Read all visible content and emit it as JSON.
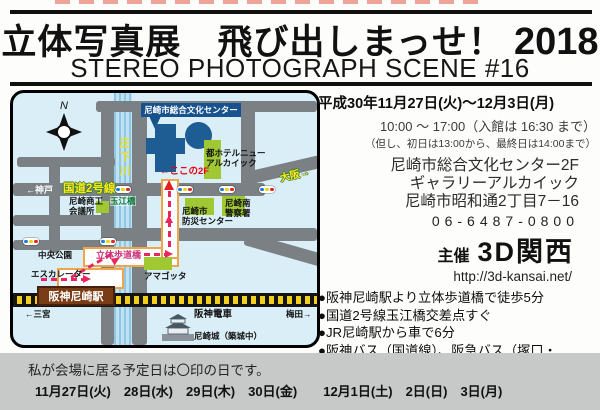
{
  "header": {
    "title_main": "立体写真展　飛び出しまっせ！",
    "title_year": "2018",
    "subtitle": "STEREO PHOTOGRAPH SCENE #16"
  },
  "info": {
    "date_line": "平成30年11月27日(火)～12月3日(月)",
    "hours_line": "10:00 ～ 17:00（入館は 16:30 まで）",
    "hours_note": "（但し、初日は13:00から、最終日は14:00まで）",
    "venue_line1": "尼崎市総合文化センター2F",
    "venue_line2": "ギャラリーアルカイック",
    "address": "尼崎市昭和通2丁目7－16",
    "phone": "06-6487-0800",
    "host_label": "主催",
    "host_name": "3D関西",
    "website": "http://3d-kansai.net/",
    "access": [
      "●阪神尼崎駅より立体歩道橋で徒歩5分",
      "●国道2号線玉江橋交差点すぐ",
      "●JR尼崎駅から車で6分",
      "●阪神バス（国道線）、阪急バス（塚口・",
      "　伊丹方面から）「尼崎文化センター前」"
    ]
  },
  "map": {
    "compass_n": "N",
    "river": "庄下川",
    "culture_center": "尼崎市総合文化センター",
    "here_2f": "←ここの2F",
    "hotel": "都ホテルニュー\nアルカイック",
    "kobe": "←神戸",
    "route2": "国道2号線",
    "osaka": "大阪→",
    "tamae_bridge": "玉江橋",
    "chamber": "尼崎商工\n会議所",
    "bosai_center": "尼崎市\n防災センター",
    "police": "尼崎南\n警察署",
    "central_park": "中央公園",
    "overpass": "立体歩道橋",
    "escalator": "エスカレーター",
    "amagotta": "アマゴッタ",
    "station": "阪神尼崎駅",
    "sannomiya": "←三宮",
    "hanshin_line": "阪神電車",
    "umeda": "梅田→",
    "castle": "尼崎城（築城中）"
  },
  "footer": {
    "note": "私が会場に居る予定日は〇印の日です。",
    "dates": "11月27日(火)　28日(水)　29日(木)　30日(金)　　12月1日(土)　2日(日)　3日(月)"
  },
  "colors": {
    "accent_red": "#e60012",
    "route_magenta": "#e8265f",
    "map_bg": "#d9eef6",
    "road_gray": "#7b8084",
    "building_green": "#a0c832",
    "building_blue": "#1e5d94",
    "rail_yellow": "#f2cf1c",
    "station_brown": "#7a3c14",
    "footer_gray": "#c6c9c7",
    "highway_label_yellow": "#ffe81e"
  }
}
